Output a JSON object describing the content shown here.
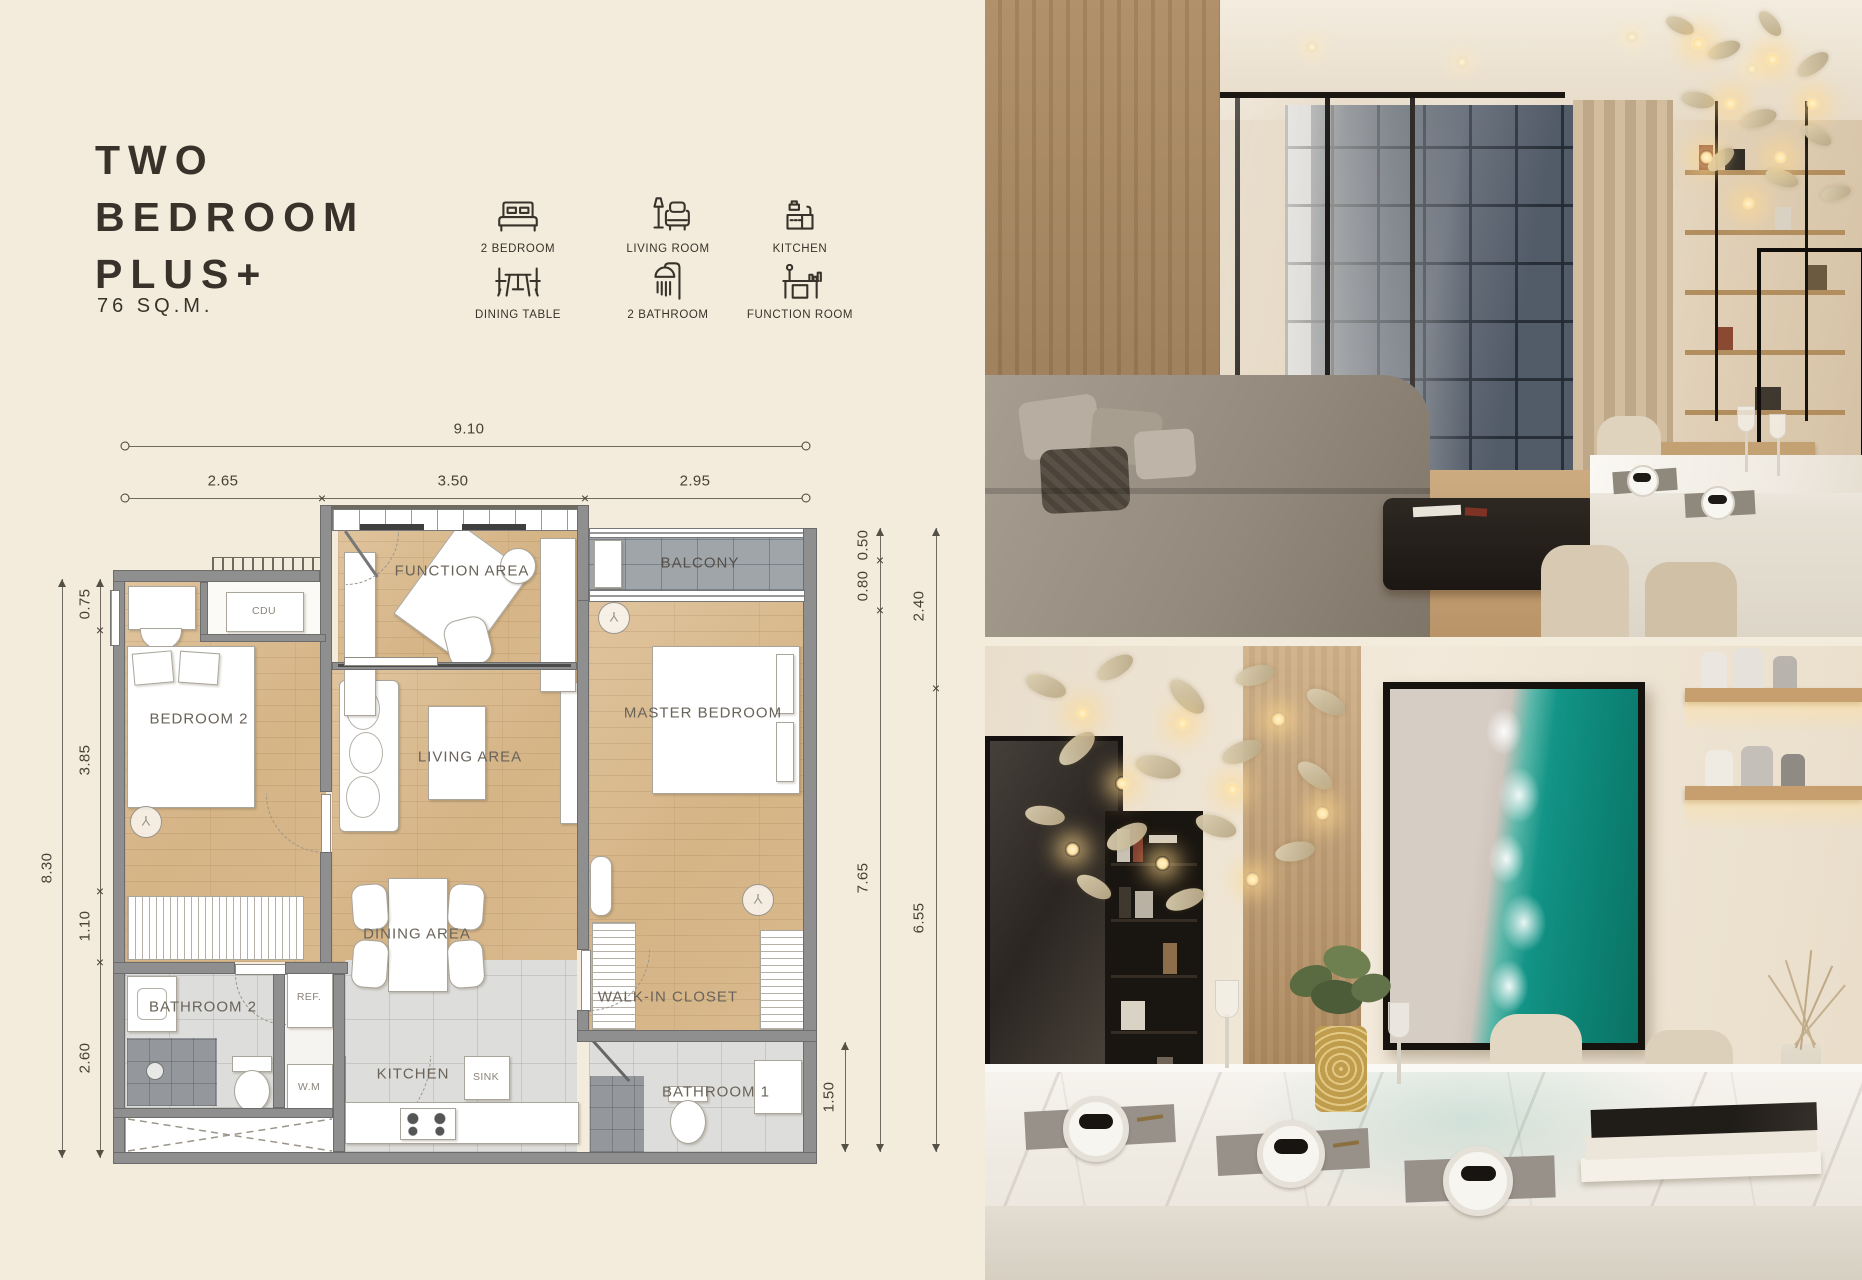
{
  "title": {
    "line1": "TWO",
    "line2": "BEDROOM",
    "line3": "PLUS+",
    "area": "76 SQ.M."
  },
  "legend": {
    "items": [
      {
        "icon": "bed-icon",
        "label": "2 BEDROOM"
      },
      {
        "icon": "sofa-lamp-icon",
        "label": "LIVING ROOM"
      },
      {
        "icon": "kitchen-sink-icon",
        "label": "KITCHEN"
      },
      {
        "icon": "dining-table-icon",
        "label": "DINING TABLE"
      },
      {
        "icon": "shower-icon",
        "label": "2 BATHROOM"
      },
      {
        "icon": "function-desk-icon",
        "label": "FUNCTION ROOM"
      }
    ]
  },
  "floorplan": {
    "rooms": {
      "function_area": "FUNCTION AREA",
      "balcony": "BALCONY",
      "bedroom_2": "BEDROOM 2",
      "master_bedroom": "MASTER BEDROOM",
      "living_area": "LIVING AREA",
      "dining_area": "DINING AREA",
      "walk_in_closet": "WALK-IN CLOSET",
      "bathroom_2": "BATHROOM 2",
      "kitchen": "KITCHEN",
      "bathroom_1": "BATHROOM 1"
    },
    "fixtures": {
      "cdu": "CDU",
      "fridge": "REF.",
      "washer": "W.M",
      "sink": "SINK"
    },
    "dims": {
      "total_width": "9.10",
      "w_left": "2.65",
      "w_mid": "3.50",
      "w_right": "2.95",
      "left_total": "8.30",
      "l1": "0.75",
      "l2": "3.85",
      "l3": "1.10",
      "l4": "2.60",
      "r1": "0.50",
      "r2": "0.80",
      "r_inner_long": "7.65",
      "r_outer_top": "2.40",
      "r_outer_long": "6.55",
      "bath1_width": "1.50"
    }
  },
  "colors": {
    "background": "#f3ecdc",
    "ink": "#39322a",
    "wall": "#8f8f8f",
    "wood_floor": "#d9ba8e",
    "tile_floor": "#dddddb",
    "balcony_floor": "#9fa5a9",
    "artwork_teal": "#129486",
    "marble": "#f4f1ec",
    "chandelier_gold": "#d4c6a8"
  }
}
